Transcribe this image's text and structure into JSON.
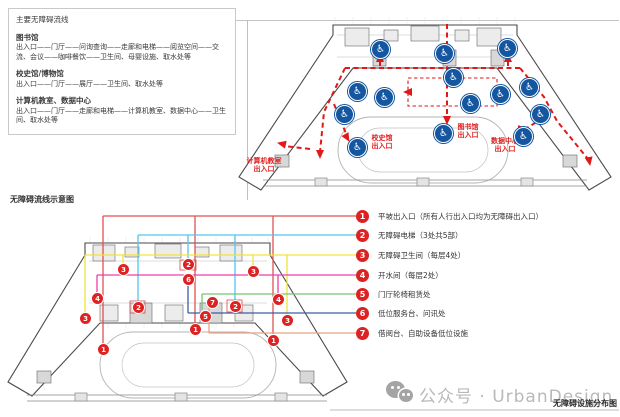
{
  "panel": {
    "title": "主要无障碍流线",
    "sections": [
      {
        "heading": "图书馆",
        "body": "出入口——门厅——问询查询——走廊和电梯——阅览空间——交流、会议——咖啡餐饮——卫生间、母婴设施、取水处等"
      },
      {
        "heading": "校史馆/博物馆",
        "body": "出入口——门厅——展厅——卫生间、取水处等"
      },
      {
        "heading": "计算机教室、数据中心",
        "body": "出入口——门厅——走廊和电梯——计算机教室、数据中心——卫生间、取水处等"
      }
    ]
  },
  "top_plan": {
    "entrance_labels": [
      {
        "lines": [
          "计算机教室",
          "出入口"
        ],
        "x": 238,
        "y": 157,
        "w": 52
      },
      {
        "lines": [
          "校史馆",
          "出入口"
        ],
        "x": 364,
        "y": 134,
        "w": 36
      },
      {
        "lines": [
          "图书馆",
          "出入口"
        ],
        "x": 450,
        "y": 123,
        "w": 36
      },
      {
        "lines": [
          "数据中心",
          "出入口"
        ],
        "x": 484,
        "y": 137,
        "w": 42
      }
    ],
    "icons": {
      "name": "wheelchair-icon",
      "glyph": "♿",
      "color": "#14569f",
      "positions": [
        [
          380,
          49
        ],
        [
          444,
          53
        ],
        [
          507,
          48
        ],
        [
          453,
          77
        ],
        [
          357,
          91
        ],
        [
          384,
          97
        ],
        [
          470,
          103
        ],
        [
          500,
          94
        ],
        [
          529,
          87
        ],
        [
          344,
          114
        ],
        [
          540,
          114
        ],
        [
          443,
          133
        ],
        [
          357,
          147
        ],
        [
          523,
          136
        ]
      ]
    },
    "flow_line_color": "#e01818"
  },
  "bottom_plan": {
    "label": "无障碍流线示意图",
    "markers": [
      {
        "n": "3",
        "x": 123,
        "y": 269
      },
      {
        "n": "2",
        "x": 188,
        "y": 264
      },
      {
        "n": "6",
        "x": 188,
        "y": 279
      },
      {
        "n": "3",
        "x": 253,
        "y": 271
      },
      {
        "n": "4",
        "x": 97,
        "y": 298
      },
      {
        "n": "2",
        "x": 138,
        "y": 307
      },
      {
        "n": "7",
        "x": 212,
        "y": 302
      },
      {
        "n": "2",
        "x": 235,
        "y": 306
      },
      {
        "n": "5",
        "x": 205,
        "y": 316
      },
      {
        "n": "4",
        "x": 278,
        "y": 299
      },
      {
        "n": "3",
        "x": 287,
        "y": 320
      },
      {
        "n": "3",
        "x": 85,
        "y": 318
      },
      {
        "n": "1",
        "x": 195,
        "y": 329
      },
      {
        "n": "1",
        "x": 103,
        "y": 349
      },
      {
        "n": "1",
        "x": 273,
        "y": 340
      }
    ]
  },
  "legend": {
    "items": [
      {
        "num": "1",
        "color": "#e05050",
        "label": "平坡出入口（所有人行出入口均为无障碍出入口）",
        "y": 216
      },
      {
        "num": "2",
        "color": "#52c6ee",
        "label": "无障碍电梯（3处共5部）",
        "y": 235
      },
      {
        "num": "3",
        "color": "#f2e33a",
        "label": "无障碍卫生间（每层4处）",
        "y": 255
      },
      {
        "num": "4",
        "color": "#ee3fae",
        "label": "开水间（每层2处）",
        "y": 275
      },
      {
        "num": "5",
        "color": "#79c273",
        "label": "门厅轮椅租赁处",
        "y": 294
      },
      {
        "num": "6",
        "color": "#3c5fa3",
        "label": "低位服务台、问讯处",
        "y": 313
      },
      {
        "num": "7",
        "color": "#eba183",
        "label": "借阅台、自助设备低位设施",
        "y": 333
      }
    ],
    "marker_color": "#dd2222"
  },
  "watermark": {
    "text": "公众号 · UrbanDesign"
  },
  "caption": "无障碍设施分布图"
}
